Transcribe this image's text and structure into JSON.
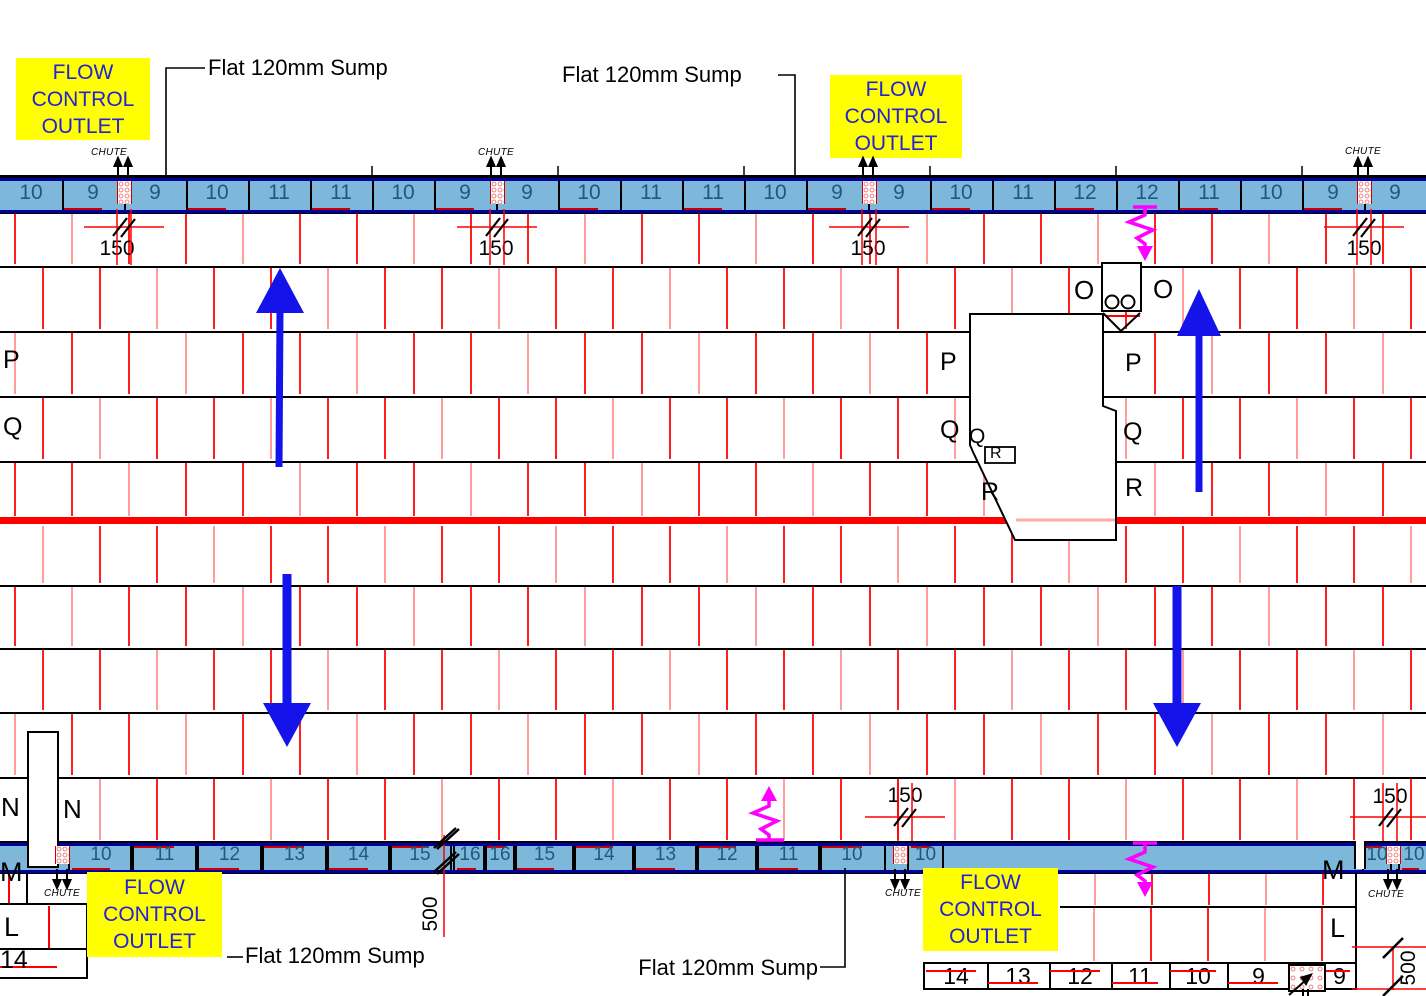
{
  "labels": {
    "flow_line1": "FLOW",
    "flow_line2": "CONTROL",
    "flow_line3": "OUTLET",
    "sump": "Flat 120mm Sump",
    "chute": "CHUTE",
    "dim150": "150",
    "dim500": "500"
  },
  "letters": {
    "o_left": "O",
    "o_right": "O",
    "p_left": "P",
    "p_core_left": "P",
    "p_core_right": "P",
    "q_left": "Q",
    "q_core_left": "Q",
    "q_small": "Q",
    "q_core_right": "Q",
    "r_small": "R",
    "r_core_left": "R",
    "r_core_right": "R",
    "n_left": "N",
    "n_right": "N",
    "m_left": "M",
    "m_right": "M",
    "l_left": "L",
    "l_right": "L",
    "bay14_left": "14"
  },
  "top_bar": {
    "cells": [
      "10",
      "9",
      "9",
      "10",
      "11",
      "11",
      "10",
      "9",
      "9",
      "10",
      "11",
      "11",
      "10",
      "9",
      "9",
      "10",
      "11",
      "12",
      "12",
      "11",
      "10",
      "9",
      "9"
    ]
  },
  "bottom_bar": {
    "cells": [
      {
        "label": "",
        "x": 0,
        "w": 68
      },
      {
        "label": "10",
        "x": 68,
        "w": 62
      },
      {
        "label": "11",
        "x": 130,
        "w": 65
      },
      {
        "label": "12",
        "x": 195,
        "w": 65
      },
      {
        "label": "13",
        "x": 260,
        "w": 65
      },
      {
        "label": "14",
        "x": 325,
        "w": 63
      },
      {
        "label": "15",
        "x": 388,
        "w": 60
      },
      {
        "label": "16",
        "x": 453,
        "w": 30
      },
      {
        "label": "16",
        "x": 483,
        "w": 30
      },
      {
        "label": "15",
        "x": 513,
        "w": 59
      },
      {
        "label": "14",
        "x": 572,
        "w": 60
      },
      {
        "label": "13",
        "x": 632,
        "w": 63
      },
      {
        "label": "12",
        "x": 695,
        "w": 60
      },
      {
        "label": "11",
        "x": 755,
        "w": 63
      },
      {
        "label": "10",
        "x": 818,
        "w": 64
      },
      {
        "label": "",
        "x": 882,
        "w": 13
      },
      {
        "label": "10",
        "x": 907,
        "w": 33
      },
      {
        "label": "",
        "x": 940,
        "w": 414
      },
      {
        "label": "10",
        "x": 1362,
        "w": 26
      },
      {
        "label": "10",
        "x": 1398,
        "w": 28
      }
    ]
  },
  "bottom_row": {
    "cells": [
      "14",
      "13",
      "12",
      "11",
      "10",
      "9",
      "9"
    ]
  },
  "colors": {
    "bar_fill": "#7db7da",
    "bar_number": "#1d5b7d",
    "bar_border_navy": "#0000a0",
    "highlight_yellow": "#ffff00",
    "label_blue": "#2222d6",
    "line_red": "#ff0000",
    "tick_red_bright": "#ff1f1f",
    "tick_red_pale": "#ff9d9d",
    "arrow_blue": "#1414ea",
    "flow_magenta": "#ff00ff"
  }
}
